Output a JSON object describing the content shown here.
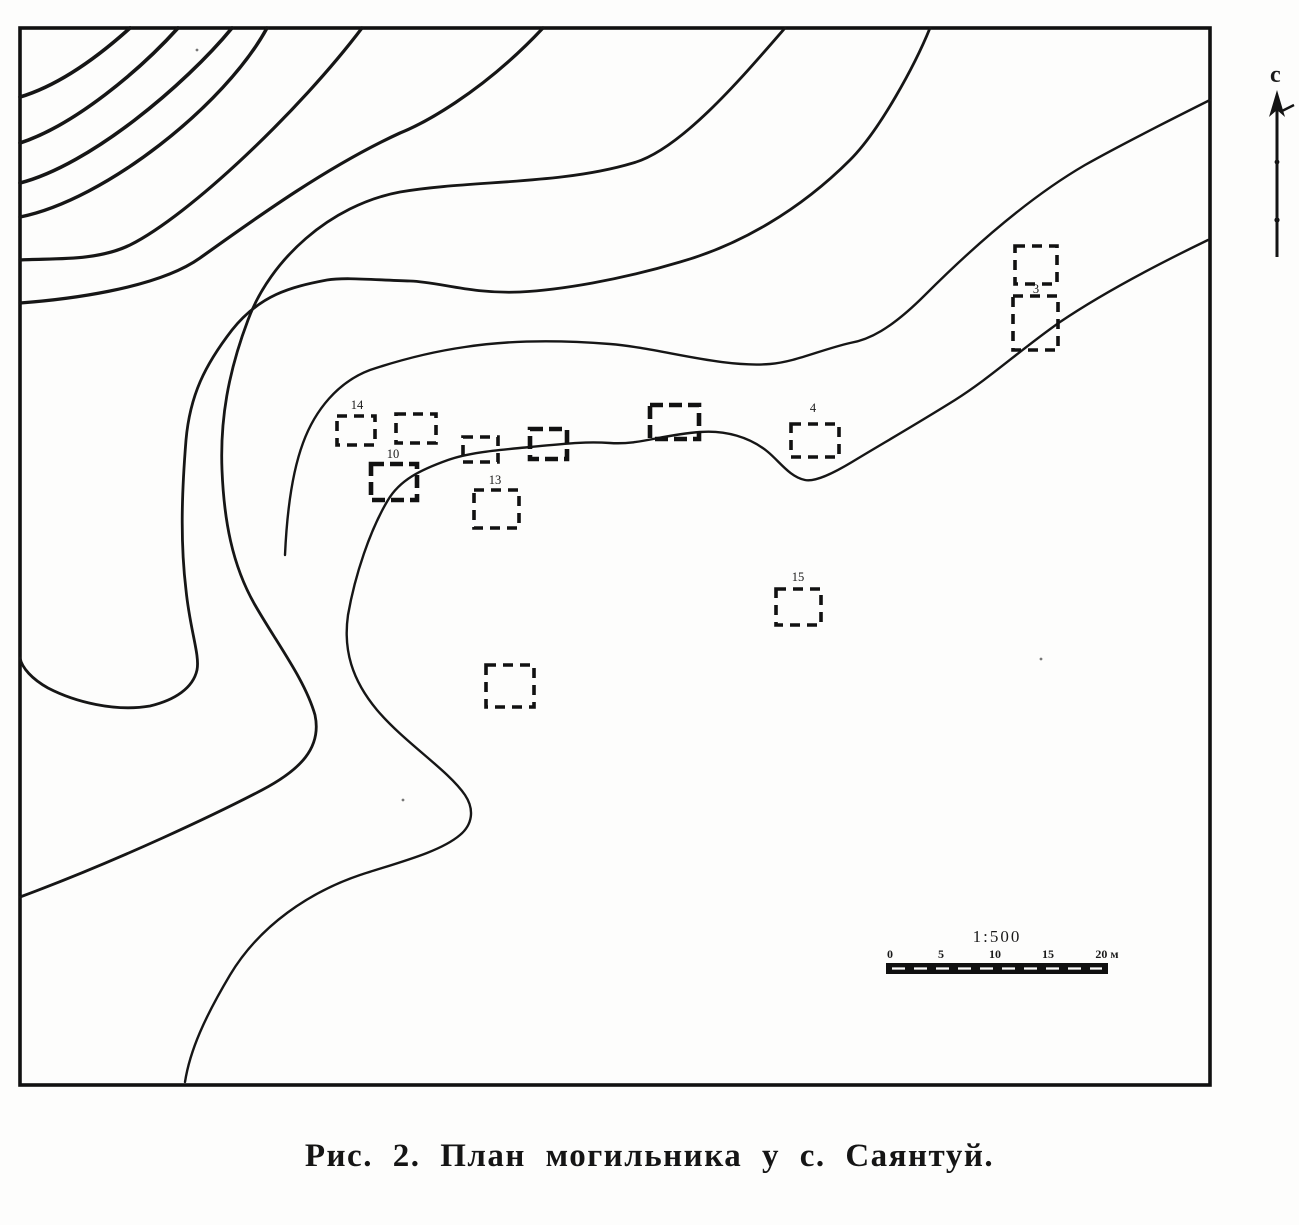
{
  "figure": {
    "caption": "Рис. 2. План могильника у с. Саянтуй."
  },
  "map": {
    "north_label": "с",
    "scale": {
      "ratio_label": "1:500",
      "tick_labels": [
        "0",
        "5",
        "10",
        "15",
        "20 м"
      ],
      "unit": "м"
    },
    "graves": [
      {
        "label": "14",
        "x": 337,
        "y": 416,
        "w": 38,
        "h": 29,
        "lx": 357,
        "ly": 409
      },
      {
        "label": "",
        "x": 396,
        "y": 414,
        "w": 40,
        "h": 29
      },
      {
        "label": "10",
        "x": 371,
        "y": 464,
        "w": 46,
        "h": 36,
        "lx": 393,
        "ly": 458,
        "bold": true
      },
      {
        "label": "",
        "x": 463,
        "y": 437,
        "w": 35,
        "h": 25
      },
      {
        "label": "",
        "x": 530,
        "y": 429,
        "w": 37,
        "h": 30,
        "bold": true
      },
      {
        "label": "13",
        "x": 474,
        "y": 490,
        "w": 45,
        "h": 38,
        "lx": 495,
        "ly": 484
      },
      {
        "label": "",
        "x": 650,
        "y": 405,
        "w": 49,
        "h": 34,
        "bold": true
      },
      {
        "label": "4",
        "x": 791,
        "y": 424,
        "w": 48,
        "h": 33,
        "lx": 813,
        "ly": 412
      },
      {
        "label": "3",
        "x": 1015,
        "y": 246,
        "w": 42,
        "h": 38,
        "lx": 1036,
        "ly": 293
      },
      {
        "label": "",
        "x": 1013,
        "y": 296,
        "w": 45,
        "h": 54
      },
      {
        "label": "15",
        "x": 776,
        "y": 589,
        "w": 45,
        "h": 36,
        "lx": 798,
        "ly": 581
      },
      {
        "label": "",
        "x": 486,
        "y": 665,
        "w": 48,
        "h": 42
      }
    ]
  }
}
